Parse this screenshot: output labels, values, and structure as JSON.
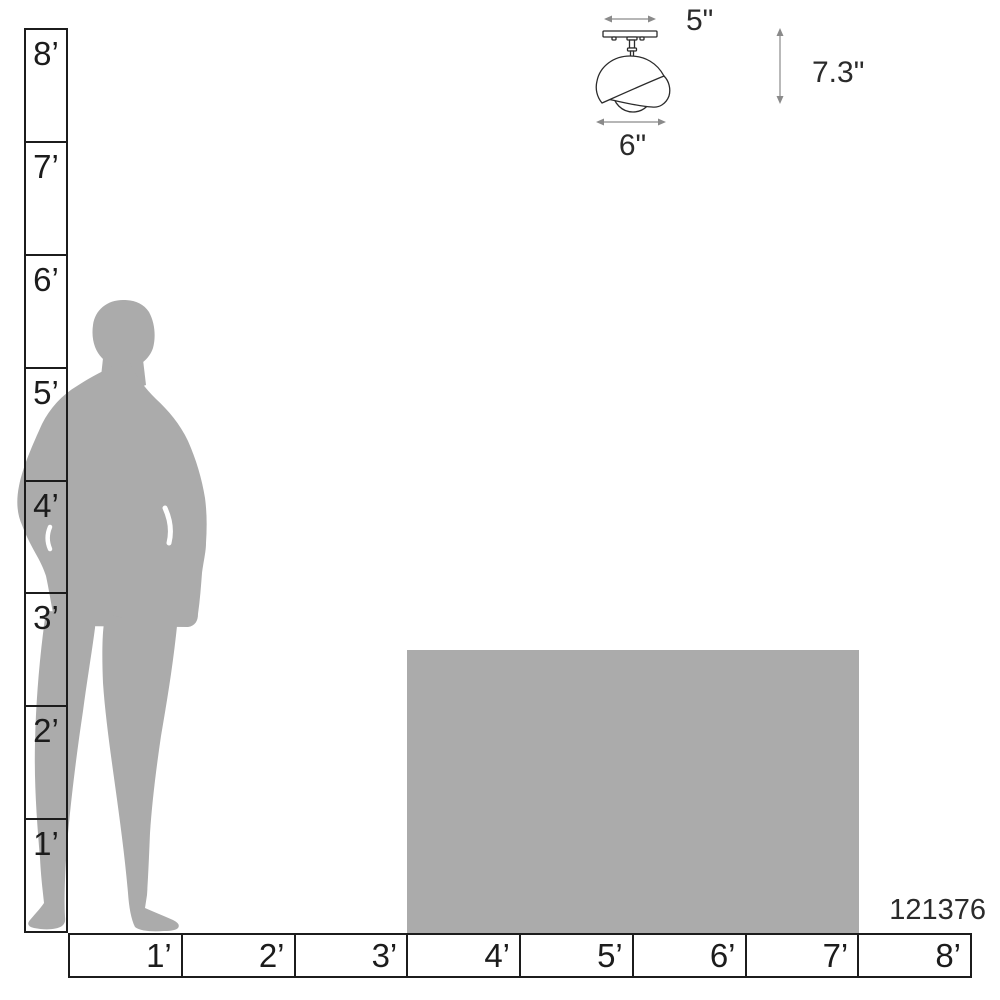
{
  "diagram": {
    "type": "product-scale-diagram",
    "product": {
      "code": "121376"
    },
    "fixture": {
      "name": "semi-flush ceiling light drawing",
      "canopy_width_label": "5\"",
      "height_label": "7.3\"",
      "shade_width_label": "6\""
    },
    "rulers": {
      "vertical": {
        "labels": [
          "8’",
          "7’",
          "6’",
          "5’",
          "4’",
          "3’",
          "2’",
          "1’"
        ]
      },
      "horizontal": {
        "labels": [
          "1’",
          "2’",
          "3’",
          "4’",
          "5’",
          "6’",
          "7’",
          "8’"
        ]
      }
    },
    "colors": {
      "silhouette_gray": "#ABABAB",
      "line_black": "#1c1c1c",
      "arrow_gray": "#8a8a8a",
      "text_dark": "#2b2b2b",
      "background": "#ffffff"
    }
  }
}
